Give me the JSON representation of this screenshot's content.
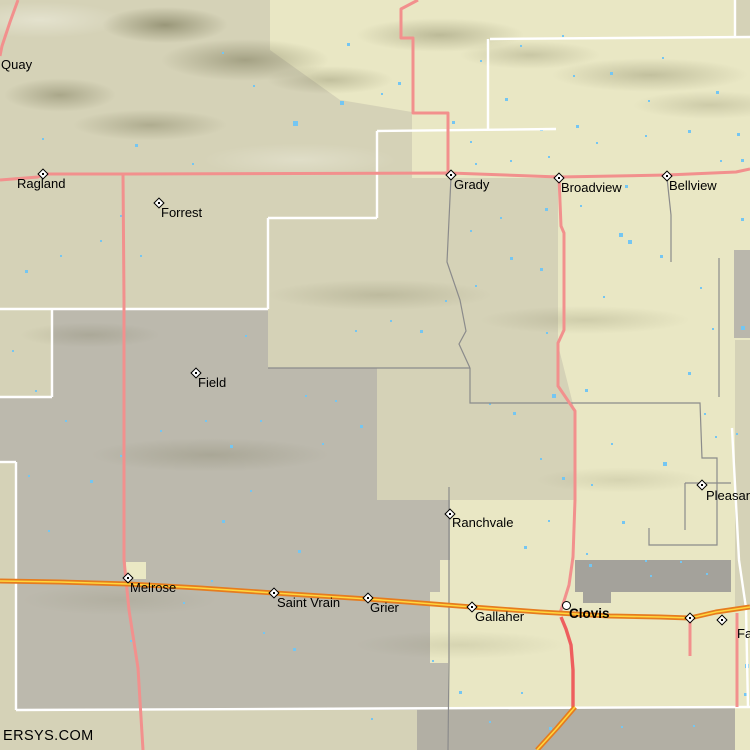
{
  "watermark": "ERSYS.COM",
  "colors": {
    "base": "#d5d2b7",
    "region_yellow": "#eae8c4",
    "region_gray": "#bab7ac",
    "urban_gray": "#a4a29b",
    "bottom_gray": "#b2afa4",
    "water_blue": "#74c6f2",
    "road_pink": "#f2908d",
    "road_red": "#ee5e5e",
    "highway_orange": "#e67c1e",
    "highway_yellow": "#ffd73e",
    "road_gray": "#8b8b8b",
    "boundary_white": "#ffffff",
    "label_black": "#000000"
  },
  "towns": [
    {
      "name": "Quay",
      "marker": "none",
      "mx": 0,
      "my": 0,
      "lx": 1,
      "ly": 58,
      "bold": false
    },
    {
      "name": "Ragland",
      "marker": "diamond",
      "mx": 43,
      "my": 174,
      "lx": 17,
      "ly": 177,
      "bold": false
    },
    {
      "name": "Forrest",
      "marker": "diamond",
      "mx": 159,
      "my": 203,
      "lx": 161,
      "ly": 206,
      "bold": false
    },
    {
      "name": "Grady",
      "marker": "diamond",
      "mx": 451,
      "my": 175,
      "lx": 454,
      "ly": 178,
      "bold": false
    },
    {
      "name": "Broadview",
      "marker": "diamond",
      "mx": 559,
      "my": 178,
      "lx": 561,
      "ly": 181,
      "bold": false
    },
    {
      "name": "Bellview",
      "marker": "diamond",
      "mx": 667,
      "my": 176,
      "lx": 669,
      "ly": 179,
      "bold": false
    },
    {
      "name": "Field",
      "marker": "diamond",
      "mx": 196,
      "my": 373,
      "lx": 198,
      "ly": 376,
      "bold": false
    },
    {
      "name": "Ranchvale",
      "marker": "diamond",
      "mx": 450,
      "my": 514,
      "lx": 452,
      "ly": 516,
      "bold": false
    },
    {
      "name": "Melrose",
      "marker": "diamond",
      "mx": 128,
      "my": 578,
      "lx": 130,
      "ly": 581,
      "bold": false
    },
    {
      "name": "Saint Vrain",
      "marker": "diamond",
      "mx": 274,
      "my": 593,
      "lx": 277,
      "ly": 596,
      "bold": false
    },
    {
      "name": "Grier",
      "marker": "diamond",
      "mx": 368,
      "my": 598,
      "lx": 370,
      "ly": 601,
      "bold": false
    },
    {
      "name": "Gallaher",
      "marker": "diamond",
      "mx": 472,
      "my": 607,
      "lx": 475,
      "ly": 610,
      "bold": false
    },
    {
      "name": "Clovis",
      "marker": "circle",
      "mx": 566,
      "my": 605,
      "lx": 569,
      "ly": 607,
      "bold": true
    },
    {
      "name": "Pleasant H",
      "marker": "diamond",
      "mx": 702,
      "my": 485,
      "lx": 706,
      "ly": 489,
      "bold": false
    },
    {
      "name": "Fa",
      "marker": "diamond",
      "mx": 722,
      "my": 620,
      "lx": 737,
      "ly": 627,
      "bold": false
    },
    {
      "name": "",
      "marker": "diamond",
      "mx": 690,
      "my": 618,
      "lx": 0,
      "ly": 0,
      "bold": false
    }
  ],
  "regions": {
    "yellow": [
      [
        270,
        0
      ],
      [
        750,
        0
      ],
      [
        750,
        750
      ],
      [
        417,
        750
      ],
      [
        417,
        712
      ],
      [
        448,
        712
      ],
      [
        448,
        663
      ],
      [
        430,
        663
      ],
      [
        430,
        592
      ],
      [
        440,
        592
      ],
      [
        440,
        560
      ],
      [
        450,
        560
      ],
      [
        450,
        500
      ],
      [
        575,
        500
      ],
      [
        575,
        412
      ],
      [
        558,
        345
      ],
      [
        558,
        178
      ],
      [
        412,
        178
      ],
      [
        412,
        112
      ],
      [
        340,
        100
      ],
      [
        270,
        50
      ]
    ],
    "gray": [
      [
        52,
        309
      ],
      [
        268,
        309
      ],
      [
        268,
        368
      ],
      [
        377,
        368
      ],
      [
        377,
        500
      ],
      [
        450,
        500
      ],
      [
        450,
        560
      ],
      [
        440,
        560
      ],
      [
        440,
        592
      ],
      [
        430,
        592
      ],
      [
        430,
        663
      ],
      [
        448,
        663
      ],
      [
        448,
        710
      ],
      [
        16,
        710
      ],
      [
        16,
        462
      ],
      [
        0,
        462
      ],
      [
        0,
        397
      ],
      [
        52,
        397
      ]
    ],
    "patches": [
      {
        "x": 575,
        "y": 560,
        "w": 156,
        "h": 32,
        "fill": "urban_gray"
      },
      {
        "x": 583,
        "y": 588,
        "w": 28,
        "h": 15,
        "fill": "urban_gray"
      },
      {
        "x": 417,
        "y": 708,
        "w": 318,
        "h": 42,
        "fill": "bottom_gray"
      },
      {
        "x": 735,
        "y": 0,
        "w": 15,
        "h": 38,
        "fill": "base"
      },
      {
        "x": 734,
        "y": 250,
        "w": 16,
        "h": 88,
        "fill": "region_gray"
      },
      {
        "x": 735,
        "y": 340,
        "w": 15,
        "h": 268,
        "fill": "base"
      },
      {
        "x": 126,
        "y": 562,
        "w": 20,
        "h": 17,
        "fill": "region_yellow"
      }
    ]
  },
  "boundaries_white": [
    [
      [
        490,
        39
      ],
      [
        750,
        37
      ]
    ],
    [
      [
        735,
        0
      ],
      [
        735,
        38
      ]
    ],
    [
      [
        488,
        39
      ],
      [
        488,
        130
      ]
    ],
    [
      [
        377,
        131
      ],
      [
        556,
        129
      ]
    ],
    [
      [
        377,
        131
      ],
      [
        377,
        218
      ]
    ],
    [
      [
        268,
        218
      ],
      [
        377,
        218
      ]
    ],
    [
      [
        268,
        218
      ],
      [
        268,
        309
      ]
    ],
    [
      [
        0,
        309
      ],
      [
        268,
        309
      ]
    ],
    [
      [
        52,
        309
      ],
      [
        52,
        397
      ]
    ],
    [
      [
        0,
        397
      ],
      [
        52,
        397
      ]
    ],
    [
      [
        0,
        462
      ],
      [
        16,
        462
      ]
    ],
    [
      [
        16,
        462
      ],
      [
        16,
        710
      ]
    ],
    [
      [
        16,
        710
      ],
      [
        750,
        707
      ]
    ],
    [
      [
        732,
        428
      ],
      [
        739,
        560
      ],
      [
        746,
        608
      ],
      [
        748,
        708
      ]
    ]
  ],
  "roads_gray": [
    [
      [
        268,
        368
      ],
      [
        470,
        368
      ]
    ],
    [
      [
        451,
        177
      ],
      [
        447,
        262
      ],
      [
        460,
        300
      ],
      [
        466,
        331
      ],
      [
        459,
        344
      ],
      [
        470,
        368
      ]
    ],
    [
      [
        470,
        368
      ],
      [
        470,
        403
      ],
      [
        700,
        403
      ],
      [
        702,
        458
      ],
      [
        717,
        458
      ],
      [
        717,
        483
      ]
    ],
    [
      [
        685,
        483
      ],
      [
        731,
        483
      ]
    ],
    [
      [
        685,
        483
      ],
      [
        685,
        530
      ]
    ],
    [
      [
        717,
        483
      ],
      [
        717,
        545
      ],
      [
        649,
        545
      ],
      [
        649,
        528
      ]
    ],
    [
      [
        667,
        178
      ],
      [
        671,
        215
      ],
      [
        671,
        262
      ]
    ],
    [
      [
        719,
        258
      ],
      [
        719,
        397
      ]
    ],
    [
      [
        449,
        487
      ],
      [
        449,
        660
      ],
      [
        448,
        750
      ]
    ]
  ],
  "roads_pink": [
    [
      [
        0,
        180
      ],
      [
        38,
        177
      ],
      [
        43,
        174
      ],
      [
        123,
        174
      ],
      [
        450,
        173
      ],
      [
        559,
        177
      ],
      [
        667,
        175
      ],
      [
        736,
        172
      ],
      [
        750,
        169
      ]
    ],
    [
      [
        123,
        174
      ],
      [
        124,
        300
      ],
      [
        124,
        560
      ],
      [
        126,
        580
      ],
      [
        129,
        610
      ],
      [
        138,
        668
      ],
      [
        143,
        750
      ]
    ],
    [
      [
        418,
        0
      ],
      [
        401,
        9
      ],
      [
        401,
        38
      ],
      [
        413,
        38
      ],
      [
        413,
        113
      ],
      [
        448,
        113
      ],
      [
        448,
        173
      ]
    ],
    [
      [
        18,
        0
      ],
      [
        10,
        22
      ],
      [
        2,
        46
      ],
      [
        0,
        56
      ]
    ],
    [
      [
        559,
        177
      ],
      [
        561,
        226
      ],
      [
        564,
        233
      ],
      [
        564,
        330
      ],
      [
        558,
        343
      ],
      [
        558,
        386
      ],
      [
        575,
        411
      ],
      [
        575,
        500
      ],
      [
        573,
        557
      ],
      [
        569,
        585
      ],
      [
        564,
        601
      ],
      [
        560,
        613
      ]
    ],
    [
      [
        690,
        618
      ],
      [
        690,
        656
      ]
    ],
    [
      [
        737,
        613
      ],
      [
        737,
        707
      ]
    ]
  ],
  "roads_red": [
    [
      [
        561,
        617
      ],
      [
        566,
        629
      ],
      [
        571,
        645
      ],
      [
        573,
        670
      ],
      [
        573,
        707
      ]
    ]
  ],
  "highways": [
    [
      [
        0,
        581
      ],
      [
        60,
        582
      ],
      [
        128,
        584
      ],
      [
        200,
        588
      ],
      [
        274,
        593
      ],
      [
        368,
        599
      ],
      [
        472,
        607
      ],
      [
        540,
        612
      ],
      [
        610,
        616
      ],
      [
        660,
        617
      ],
      [
        690,
        618
      ],
      [
        716,
        612
      ],
      [
        750,
        607
      ]
    ],
    [
      [
        575,
        707
      ],
      [
        557,
        728
      ],
      [
        537,
        750
      ]
    ]
  ],
  "lakes": [
    [
      347,
      43,
      3
    ],
    [
      398,
      82,
      3
    ],
    [
      340,
      101,
      4
    ],
    [
      293,
      121,
      5
    ],
    [
      381,
      93,
      2
    ],
    [
      452,
      121,
      3
    ],
    [
      470,
      141,
      2
    ],
    [
      505,
      98,
      3
    ],
    [
      540,
      128,
      3
    ],
    [
      573,
      75,
      2
    ],
    [
      610,
      72,
      3
    ],
    [
      648,
      100,
      2
    ],
    [
      688,
      130,
      3
    ],
    [
      716,
      91,
      3
    ],
    [
      737,
      133,
      3
    ],
    [
      662,
      57,
      2
    ],
    [
      576,
      125,
      3
    ],
    [
      619,
      233,
      4
    ],
    [
      540,
      268,
      3
    ],
    [
      546,
      332,
      2
    ],
    [
      603,
      296,
      2
    ],
    [
      660,
      255,
      3
    ],
    [
      700,
      287,
      2
    ],
    [
      628,
      240,
      4
    ],
    [
      688,
      372,
      3
    ],
    [
      712,
      328,
      2
    ],
    [
      741,
      326,
      4
    ],
    [
      585,
      389,
      3
    ],
    [
      552,
      394,
      4
    ],
    [
      611,
      443,
      2
    ],
    [
      663,
      462,
      4
    ],
    [
      489,
      403,
      2
    ],
    [
      513,
      412,
      3
    ],
    [
      540,
      458,
      2
    ],
    [
      562,
      477,
      3
    ],
    [
      591,
      484,
      2
    ],
    [
      622,
      521,
      3
    ],
    [
      548,
      520,
      2
    ],
    [
      524,
      546,
      3
    ],
    [
      586,
      553,
      2
    ],
    [
      645,
      560,
      2
    ],
    [
      680,
      561,
      2
    ],
    [
      706,
      573,
      2
    ],
    [
      745,
      664,
      4
    ],
    [
      744,
      693,
      3
    ],
    [
      715,
      436,
      2
    ],
    [
      736,
      433,
      2
    ],
    [
      704,
      413,
      2
    ],
    [
      741,
      218,
      3
    ],
    [
      720,
      160,
      2
    ],
    [
      741,
      159,
      3
    ],
    [
      645,
      135,
      2
    ],
    [
      596,
      142,
      2
    ],
    [
      548,
      156,
      2
    ],
    [
      510,
      160,
      2
    ],
    [
      475,
      163,
      2
    ],
    [
      625,
      185,
      3
    ],
    [
      580,
      205,
      2
    ],
    [
      545,
      208,
      3
    ],
    [
      500,
      217,
      2
    ],
    [
      470,
      230,
      2
    ],
    [
      510,
      257,
      3
    ],
    [
      475,
      285,
      2
    ],
    [
      445,
      300,
      2
    ],
    [
      420,
      330,
      3
    ],
    [
      390,
      320,
      2
    ],
    [
      355,
      330,
      2
    ],
    [
      245,
      335,
      2
    ],
    [
      140,
      255,
      2
    ],
    [
      100,
      240,
      2
    ],
    [
      60,
      255,
      2
    ],
    [
      25,
      270,
      3
    ],
    [
      42,
      138,
      2
    ],
    [
      135,
      144,
      3
    ],
    [
      192,
      163,
      2
    ],
    [
      222,
      52,
      2
    ],
    [
      253,
      85,
      2
    ],
    [
      120,
      215,
      2
    ],
    [
      298,
      550,
      3
    ],
    [
      322,
      443,
      2
    ],
    [
      211,
      580,
      2
    ],
    [
      183,
      602,
      2
    ],
    [
      130,
      640,
      2
    ],
    [
      263,
      632,
      2
    ],
    [
      293,
      648,
      3
    ],
    [
      432,
      660,
      2
    ],
    [
      371,
      718,
      2
    ],
    [
      459,
      691,
      3
    ],
    [
      489,
      721,
      2
    ],
    [
      521,
      692,
      2
    ],
    [
      549,
      727,
      3
    ],
    [
      621,
      726,
      2
    ],
    [
      693,
      725,
      2
    ],
    [
      305,
      395,
      2
    ],
    [
      335,
      400,
      2
    ],
    [
      360,
      425,
      3
    ],
    [
      260,
      420,
      2
    ],
    [
      230,
      445,
      3
    ],
    [
      205,
      420,
      2
    ],
    [
      160,
      430,
      2
    ],
    [
      120,
      455,
      2
    ],
    [
      90,
      480,
      3
    ],
    [
      65,
      420,
      2
    ],
    [
      35,
      390,
      2
    ],
    [
      12,
      350,
      2
    ],
    [
      562,
      35,
      2
    ],
    [
      520,
      45,
      2
    ],
    [
      480,
      60,
      2
    ],
    [
      250,
      490,
      2
    ],
    [
      222,
      520,
      3
    ],
    [
      48,
      530,
      2
    ],
    [
      28,
      475,
      2
    ],
    [
      589,
      564,
      3
    ],
    [
      650,
      575,
      2
    ]
  ]
}
